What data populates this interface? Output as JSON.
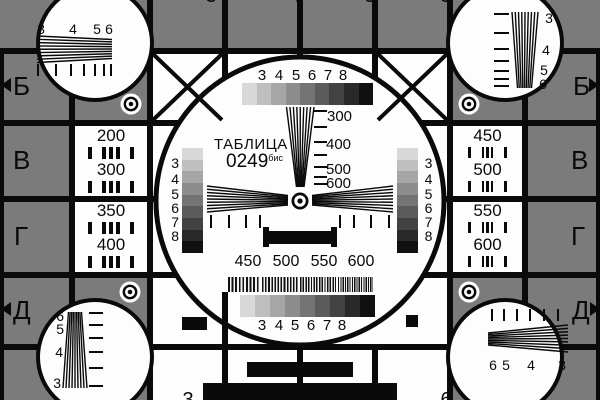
{
  "colors": {
    "background": "#7b7b7b",
    "panel_white": "#fdfdfd",
    "ink": "#0a0a0a"
  },
  "center": {
    "title": "ТАБЛИЦА",
    "number": "0249",
    "number_suffix": "бис",
    "grayscale_labels": [
      "3",
      "4",
      "5",
      "6",
      "7",
      "8"
    ],
    "wedge_labels": [
      "300",
      "400",
      "500",
      "600"
    ],
    "burst_labels": [
      "450",
      "500",
      "550",
      "600"
    ]
  },
  "corners": {
    "top_left": {
      "numbers": [
        "3",
        "4",
        "5",
        "6"
      ]
    },
    "top_right": {
      "numbers": [
        "3",
        "4",
        "5",
        "6"
      ]
    },
    "bottom_left": {
      "numbers": [
        "6",
        "5",
        "4",
        "3"
      ]
    },
    "bottom_right": {
      "numbers": [
        "6",
        "5",
        "4",
        "3"
      ]
    }
  },
  "panels": {
    "left": [
      "200",
      "300",
      "350",
      "400"
    ],
    "right": [
      "450",
      "500",
      "550",
      "600"
    ]
  },
  "rows": {
    "left": [
      "Б",
      "В",
      "Г",
      "Д"
    ],
    "right": [
      "Б",
      "В",
      "Г",
      "Д"
    ]
  },
  "columns": {
    "top": [
      "3",
      "4",
      "5",
      "6"
    ],
    "bottom": [
      "3",
      "4",
      "5",
      "6"
    ]
  },
  "grayscale_steps": [
    "#d8d8d8",
    "#bfbfbf",
    "#a6a6a6",
    "#8d8d8d",
    "#747474",
    "#5b5b5b",
    "#424242",
    "#292929",
    "#101010"
  ]
}
